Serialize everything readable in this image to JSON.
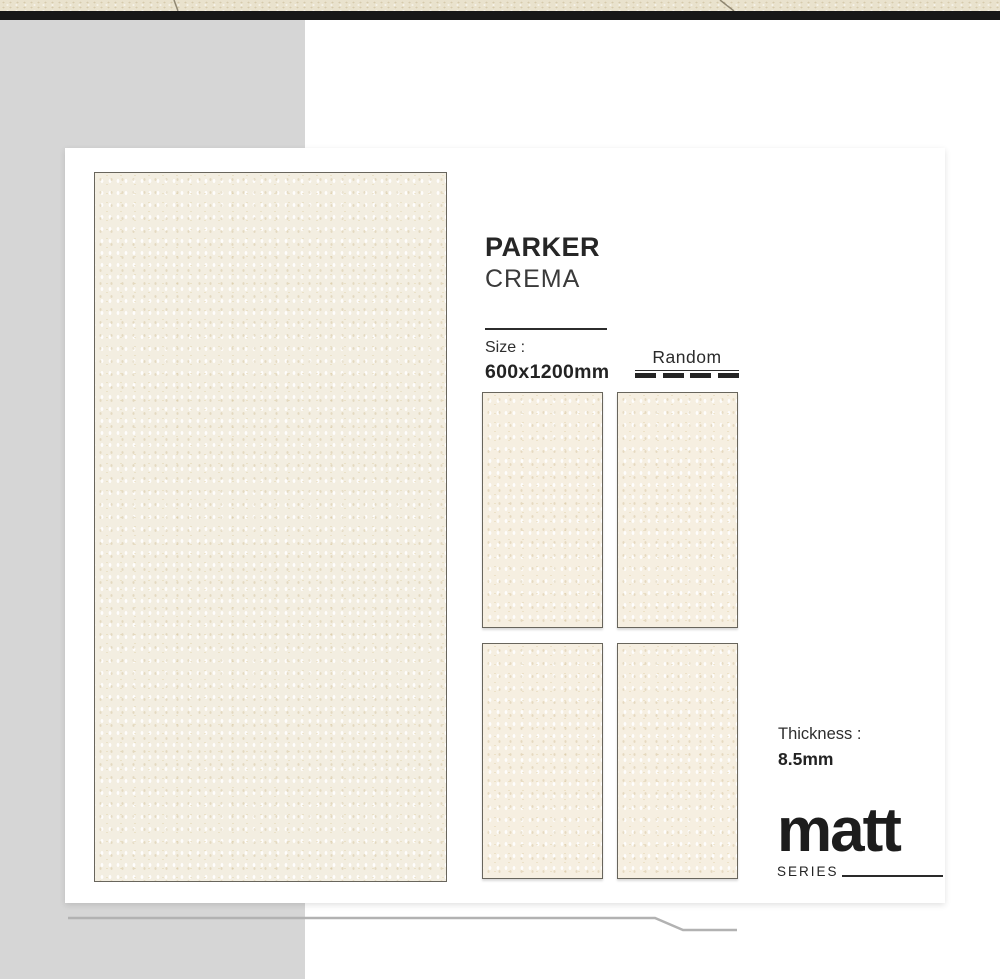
{
  "product": {
    "name": "PARKER",
    "variant": "CREMA"
  },
  "size": {
    "label": "Size :",
    "value": "600x1200mm"
  },
  "pattern": {
    "label": "Random"
  },
  "thickness": {
    "label": "Thickness :",
    "value": "8.5mm"
  },
  "series": {
    "logo": "matt",
    "label": "SERIES"
  },
  "swatches": {
    "large_swatch_count": 1,
    "face_variant_count": 4
  },
  "colors": {
    "top_texture_beige": "#e9e2cd",
    "top_bar_black": "#171717",
    "side_panel_gray": "#d6d6d6",
    "card_white": "#ffffff",
    "tile_cream": "#f6efe1",
    "tile_border": "#68655c",
    "text_dark": "#262626",
    "decor_line_gray": "#b2b2b2"
  }
}
